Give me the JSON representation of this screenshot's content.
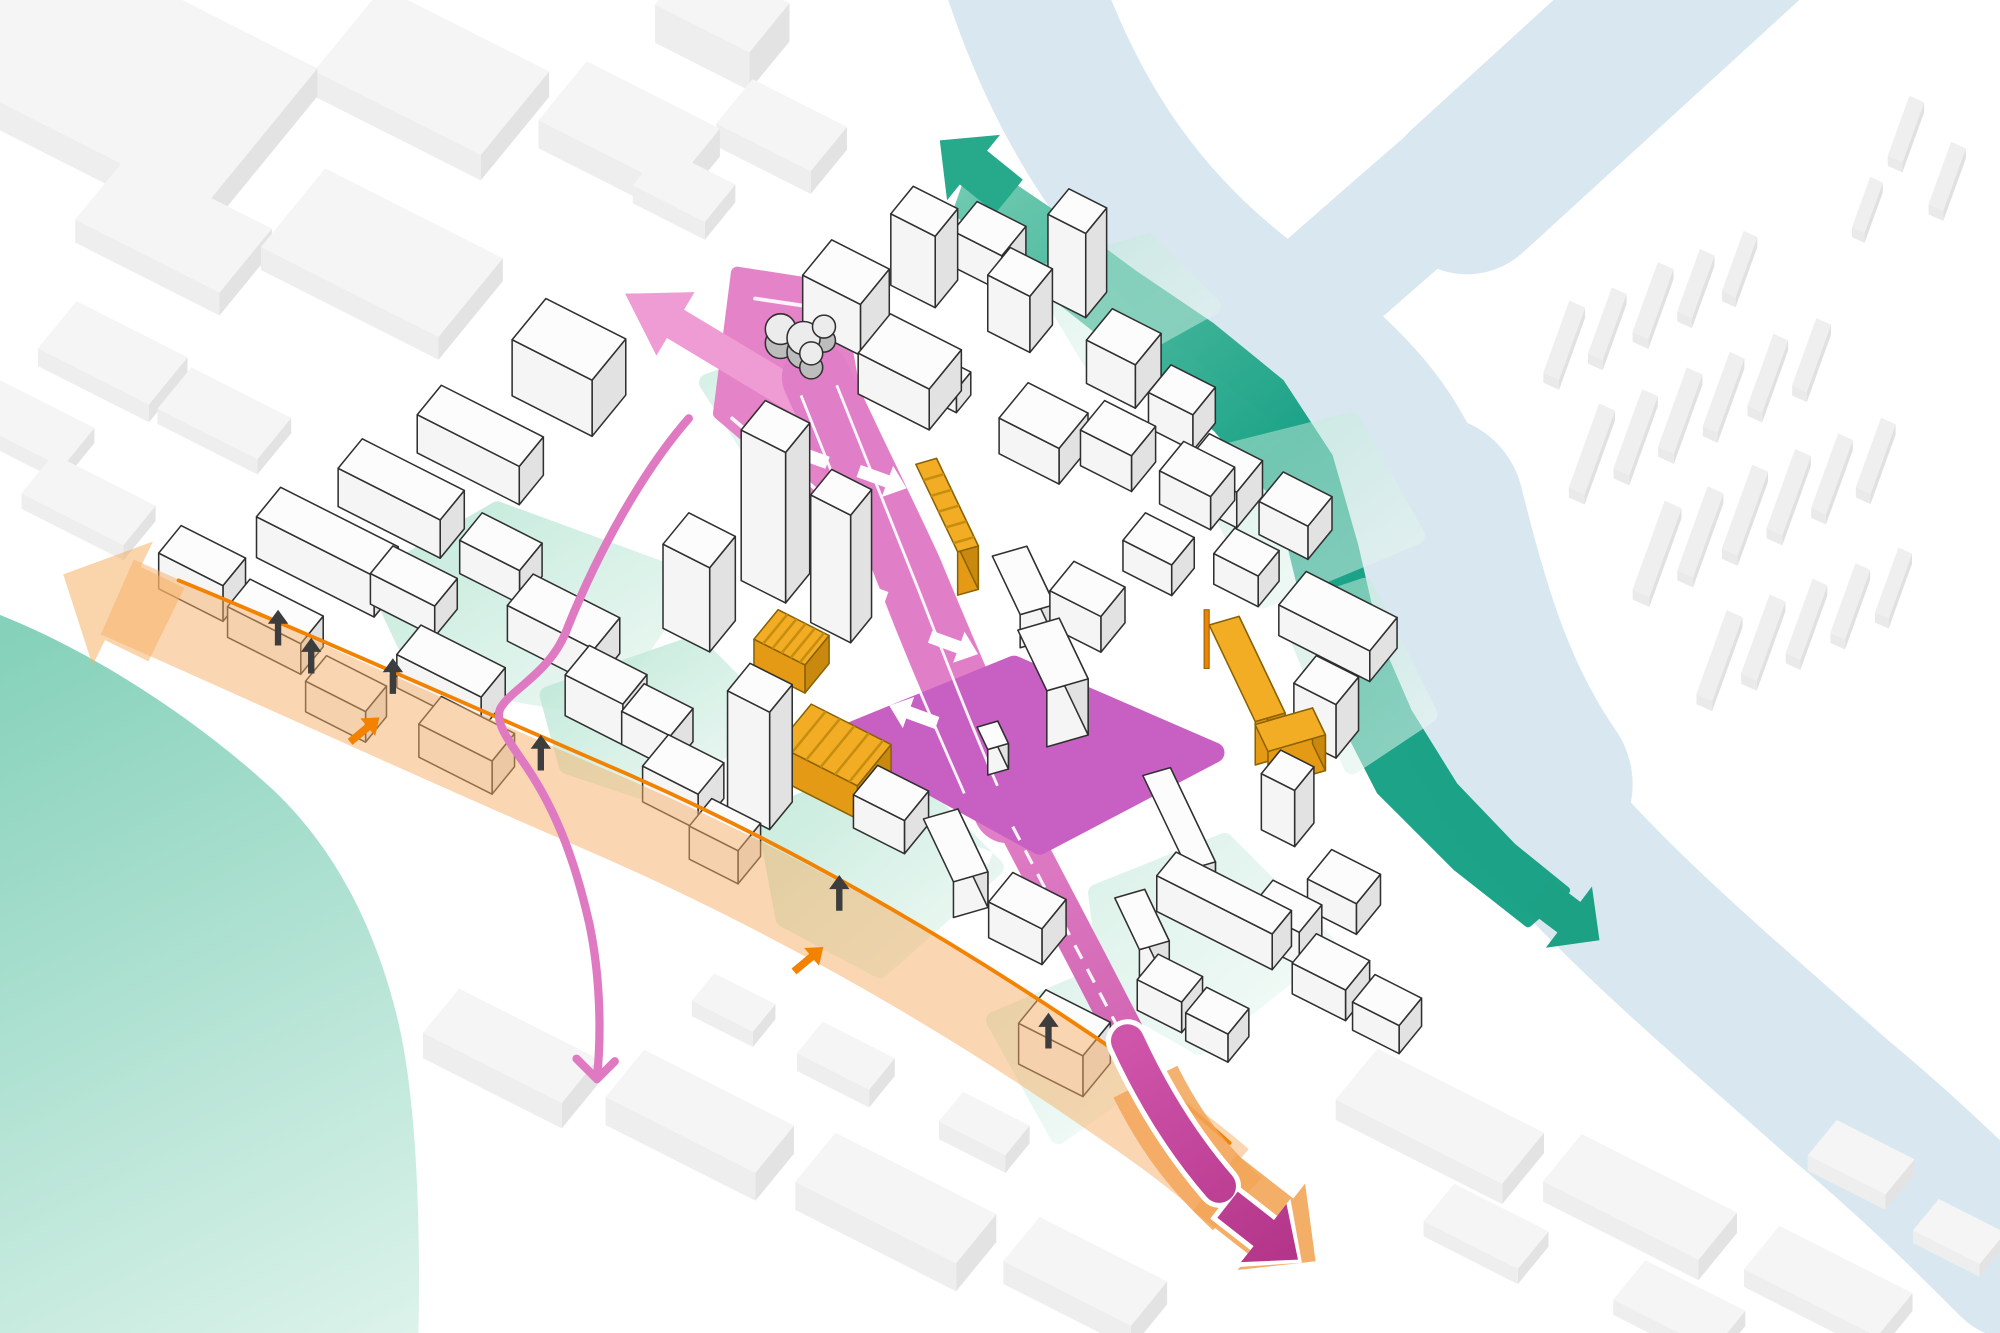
{
  "diagram_type": "urban-masterplan-axonometric",
  "palette": {
    "river": "#d9e8f0",
    "water_sw_dark": "#85d1ba",
    "water_sw_light": "#ddf3eb",
    "green_dark": "#14a083",
    "green_light": "#6cc9ae",
    "green_arrow_top": "#27a98b",
    "green_arrow_bottom": "#1da184",
    "mint": "#b7e6d4",
    "mint_fade": "#eef9f4",
    "street_pink": "#e07fc7",
    "street_pink_dark": "#cf5fae",
    "wedge_pink": "#e583c8",
    "arrow_pink_light": "#f09cd4",
    "branch_pink": "#df7ac2",
    "plaza_magenta": "#c85fc3",
    "exit_magenta_a": "#cf55aa",
    "exit_magenta_b": "#b23388",
    "orange_band": "#f6b066",
    "orange_line": "#f28200",
    "exit_orange": "#f2a558",
    "yellow_top": "#f3ad25",
    "yellow_light": "#e49a15",
    "yellow_dark": "#c9880e",
    "yellow_stroke": "#8a6200",
    "yellow_hatch": "#c78d0f",
    "district_top": "#fcfcfc",
    "district_light": "#f5f5f5",
    "district_dark": "#e2e2e2",
    "district_stroke": "#2f2f2f",
    "ctx_top": "#f5f5f5",
    "ctx_light": "#eeeeee",
    "ctx_dark": "#e3e3e3",
    "far_top": "#efefef",
    "far_light": "#eaeaea",
    "far_dark": "#e1e1e1",
    "black_arrow": "#3d3d3d",
    "white": "#ffffff",
    "blob_top": "#ececec",
    "blob_side": "#bdbdbd"
  },
  "river": {
    "paths": [
      {
        "d": "M800,-20 C840,100 900,180 980,240 C1060,300 1100,340 1120,420 C1140,500 1150,560 1200,630 C1260,705 1350,780 1440,860 C1500,910 1540,950 1580,990",
        "w": 120
      },
      {
        "d": "M1120,400 C1140,480 1160,550 1205,615",
        "w": 150
      },
      {
        "d": "M1010,250 C1090,180 1180,100 1280,20 L1340,-30",
        "w": 95
      },
      {
        "d": "M1150,150 L1380,-60",
        "w": 130
      }
    ]
  },
  "water_sw": {
    "d": "M0,482 C70,510 150,560 215,620 C265,668 295,730 312,800 C326,860 330,950 328,1050 L0,1050 Z"
  },
  "green_band": {
    "d": "M764,126 L826,168 L888,214 L950,256 L1004,300 L1042,358 L1062,428 L1078,498 L1104,558 L1140,616 L1186,664 L1228,698 L1198,724 L1142,680 L1082,620 L1044,546 L1022,468 L1004,394 L954,336 L890,282 L824,230 L750,166 Z",
    "heads": [
      {
        "cx": 764,
        "cy": 132,
        "ang": -141,
        "len": 70,
        "w": 34,
        "hw": 66,
        "hl": 34,
        "color_key": "green_arrow_top"
      },
      {
        "cx": 1230,
        "cy": 719,
        "ang": 37,
        "len": 60,
        "w": 30,
        "hw": 60,
        "hl": 30,
        "color_key": "green_arrow_bottom"
      }
    ]
  },
  "mint_areas": [
    {
      "d": "M295,455 L390,400 L540,455 L470,555 L330,530 Z",
      "o": 0.85
    },
    {
      "d": "M430,545 L545,505 L600,560 L520,625 L445,600 Z",
      "o": 0.85
    },
    {
      "d": "M555,300 L640,270 L680,330 L600,370 Z",
      "o": 0.6
    },
    {
      "d": "M815,215 L900,190 L950,240 L860,290 Z",
      "o": 0.45
    },
    {
      "d": "M940,360 L1060,330 L1110,420 L990,470 Z",
      "o": 0.5
    },
    {
      "d": "M1010,480 L1070,460 L1120,560 L1060,600 Z",
      "o": 0.55
    },
    {
      "d": "M600,640 L700,600 L780,680 L690,760 L615,720 Z",
      "o": 0.8
    },
    {
      "d": "M860,700 L960,660 L1040,740 L940,820 L870,780 Z",
      "o": 0.5
    },
    {
      "d": "M780,800 L850,770 L900,840 L830,890 Z",
      "o": 0.5
    }
  ],
  "pink_route": {
    "wedge": {
      "d": "M578,214 L655,226 L670,310 L702,396 L658,404 L564,324 Z"
    },
    "wedge_white_lines": [
      "M592,234 L646,242 L660,314 L686,388",
      "M652,394 L574,328"
    ],
    "top_arrow": {
      "cx": 578,
      "cy": 283,
      "ang": 211,
      "len": 205,
      "w": 26,
      "hw": 58,
      "hl": 46
    },
    "street_seg1": {
      "d": "M640,296 C660,340 690,400 712,448 C740,516 760,560 780,610 L790,634",
      "w": 54
    },
    "street_seg2": {
      "d": "M786,626 C810,672 830,710 852,752 C874,794 890,826 912,868",
      "w": 30
    },
    "connector": "820,612 776,632 756,592 800,572",
    "plaza": {
      "d": "M660,577 L795,522 L952,590 L815,662 Z"
    },
    "lane_lines": [
      "M628,310 C648,360 672,420 692,470 C716,532 736,576 756,622",
      "M656,302 C676,352 700,412 720,462 C744,524 762,570 782,616"
    ],
    "dashed_line": "M794,648 L906,862",
    "white_arrows": [
      {
        "x": 630,
        "y": 356,
        "ang": 200
      },
      {
        "x": 692,
        "y": 376,
        "ang": 20
      },
      {
        "x": 676,
        "y": 462,
        "ang": 200
      },
      {
        "x": 748,
        "y": 506,
        "ang": 20
      },
      {
        "x": 716,
        "y": 560,
        "ang": 200
      },
      {
        "x": 758,
        "y": 666,
        "ang": 200
      }
    ],
    "branch": {
      "d": "M540,328 C505,368 470,430 445,492 C432,528 400,540 392,556 C388,566 398,580 412,600 C438,638 452,680 462,724 C470,762 472,806 468,846",
      "w": 6.5,
      "head": [
        "M468,846 L452,830",
        "M468,846 L482,832"
      ]
    }
  },
  "orange_band": {
    "band": {
      "d": "M92,468 C210,520 340,580 470,636 C600,692 740,768 880,866 C912,888 935,905 958,925",
      "w": 64,
      "o": 0.5
    },
    "head": {
      "cx": 90,
      "cy": 470,
      "ang": 206,
      "len": 90,
      "w": 64,
      "hw": 108,
      "hl": 52,
      "o": 0.55
    },
    "boundary": "M140,455 C245,498 365,552 490,606 C618,662 754,740 892,836 C920,858 942,876 964,896",
    "small_arrows": [
      {
        "x": 286,
        "y": 572,
        "ang": -40
      },
      {
        "x": 634,
        "y": 752,
        "ang": -40
      }
    ]
  },
  "exit_arrows": {
    "orange_path": {
      "d": "M898,848 C920,892 942,918 970,944",
      "w": 56
    },
    "orange_head": {
      "cx": 992,
      "cy": 958,
      "ang": 38,
      "len": 100,
      "w": 56,
      "hw": 86,
      "hl": 44
    },
    "white_path": {
      "d": "M884,816 C906,864 930,900 956,930",
      "w": 34
    },
    "white_head": {
      "cx": 990,
      "cy": 966,
      "ang": 38,
      "len": 78,
      "w": 34,
      "hw": 68,
      "hl": 38
    },
    "magenta_path": {
      "d": "M884,816 C906,864 930,900 956,930",
      "w": 26
    },
    "magenta_head": {
      "cx": 990,
      "cy": 966,
      "ang": 38,
      "len": 70,
      "w": 26,
      "hw": 58,
      "hl": 34
    }
  },
  "black_arrows": [
    {
      "x": 218,
      "y": 492
    },
    {
      "x": 244,
      "y": 514
    },
    {
      "x": 308,
      "y": 530
    },
    {
      "x": 424,
      "y": 590
    },
    {
      "x": 658,
      "y": 700
    },
    {
      "x": 822,
      "y": 808
    }
  ],
  "buildings": {
    "context": [
      [
        40,
        -30,
        240,
        140,
        22
      ],
      [
        300,
        10,
        150,
        85,
        20
      ],
      [
        460,
        70,
        120,
        60,
        22
      ],
      [
        545,
        -5,
        85,
        50,
        30
      ],
      [
        590,
        80,
        85,
        45,
        18
      ],
      [
        100,
        140,
        130,
        65,
        18
      ],
      [
        255,
        150,
        160,
        80,
        18
      ],
      [
        60,
        250,
        100,
        48,
        14
      ],
      [
        0,
        310,
        85,
        40,
        12
      ],
      [
        42,
        368,
        92,
        40,
        12
      ],
      [
        150,
        300,
        90,
        42,
        12
      ],
      [
        520,
        130,
        65,
        38,
        14
      ],
      [
        360,
        795,
        125,
        45,
        20
      ],
      [
        505,
        845,
        135,
        48,
        22
      ],
      [
        655,
        910,
        145,
        50,
        22
      ],
      [
        815,
        972,
        115,
        45,
        18
      ],
      [
        560,
        775,
        55,
        28,
        12
      ],
      [
        645,
        815,
        65,
        32,
        14
      ],
      [
        755,
        870,
        60,
        30,
        14
      ],
      [
        1080,
        838,
        150,
        52,
        16
      ],
      [
        1240,
        905,
        140,
        48,
        16
      ],
      [
        1395,
        975,
        120,
        44,
        14
      ],
      [
        1140,
        940,
        85,
        38,
        12
      ],
      [
        1290,
        1000,
        90,
        40,
        12
      ],
      [
        1440,
        890,
        70,
        36,
        12
      ],
      [
        1520,
        950,
        60,
        32,
        10
      ]
    ],
    "far_slabs": [
      [
        1210,
        300,
        60,
        15
      ],
      [
        1245,
        285,
        55,
        14
      ],
      [
        1280,
        268,
        58,
        15
      ],
      [
        1315,
        252,
        52,
        14
      ],
      [
        1350,
        236,
        50,
        13
      ],
      [
        1230,
        390,
        70,
        15
      ],
      [
        1265,
        375,
        66,
        15
      ],
      [
        1300,
        358,
        66,
        15
      ],
      [
        1335,
        342,
        62,
        14
      ],
      [
        1370,
        326,
        60,
        14
      ],
      [
        1405,
        310,
        56,
        14
      ],
      [
        1280,
        470,
        74,
        16
      ],
      [
        1315,
        455,
        70,
        15
      ],
      [
        1350,
        438,
        70,
        15
      ],
      [
        1385,
        422,
        66,
        15
      ],
      [
        1420,
        406,
        62,
        14
      ],
      [
        1455,
        390,
        58,
        14
      ],
      [
        1330,
        552,
        70,
        15
      ],
      [
        1365,
        536,
        66,
        15
      ],
      [
        1400,
        520,
        62,
        14
      ],
      [
        1435,
        504,
        58,
        14
      ],
      [
        1470,
        488,
        54,
        13
      ],
      [
        1480,
        130,
        50,
        14
      ],
      [
        1512,
        168,
        52,
        14
      ],
      [
        1452,
        186,
        42,
        12
      ]
    ],
    "district": [
      [
        652,
        228,
        52,
        36,
        40,
        "A",
        "d"
      ],
      [
        716,
        202,
        40,
        28,
        56,
        "A",
        "d"
      ],
      [
        766,
        186,
        44,
        30,
        28,
        "A",
        "d"
      ],
      [
        698,
        278,
        64,
        40,
        32,
        "A",
        "d"
      ],
      [
        742,
        300,
        22,
        18,
        18,
        "A",
        "d"
      ],
      [
        792,
        238,
        38,
        28,
        44,
        "A",
        "d"
      ],
      [
        838,
        214,
        34,
        26,
        66,
        "A",
        "d"
      ],
      [
        872,
        276,
        44,
        32,
        34,
        "A",
        "d"
      ],
      [
        806,
        328,
        54,
        36,
        28,
        "A",
        "d"
      ],
      [
        866,
        342,
        46,
        30,
        28,
        "A",
        "d"
      ],
      [
        918,
        314,
        40,
        28,
        28,
        "A",
        "d"
      ],
      [
        928,
        372,
        46,
        30,
        26,
        "A",
        "d"
      ],
      [
        428,
        278,
        72,
        42,
        44,
        "A",
        "d"
      ],
      [
        346,
        332,
        92,
        30,
        30,
        "A",
        "d"
      ],
      [
        284,
        374,
        92,
        30,
        30,
        "A",
        "d"
      ],
      [
        220,
        414,
        106,
        30,
        32,
        "A",
        "d"
      ],
      [
        142,
        440,
        58,
        28,
        28,
        "A",
        "d"
      ],
      [
        196,
        478,
        66,
        28,
        24,
        "A",
        "d"
      ],
      [
        308,
        452,
        58,
        28,
        24,
        "A",
        "d"
      ],
      [
        378,
        428,
        54,
        28,
        26,
        "A",
        "d"
      ],
      [
        418,
        478,
        78,
        32,
        28,
        "A",
        "d"
      ],
      [
        330,
        516,
        76,
        30,
        26,
        "A",
        "d"
      ],
      [
        256,
        538,
        54,
        26,
        24,
        "A",
        "d"
      ],
      [
        346,
        572,
        66,
        28,
        26,
        "A",
        "d"
      ],
      [
        462,
        538,
        52,
        30,
        32,
        "A",
        "d"
      ],
      [
        600,
        432,
        40,
        30,
        118,
        "A",
        "d"
      ],
      [
        652,
        468,
        36,
        26,
        100,
        "A",
        "d"
      ],
      [
        540,
        468,
        42,
        32,
        66,
        "A",
        "d"
      ],
      [
        505,
        562,
        44,
        28,
        26,
        "A",
        "d"
      ],
      [
        588,
        612,
        38,
        28,
        92,
        "A",
        "d"
      ],
      [
        524,
        604,
        50,
        32,
        28,
        "A",
        "d"
      ],
      [
        558,
        652,
        44,
        28,
        26,
        "A",
        "d"
      ],
      [
        778,
        462,
        52,
        30,
        26,
        "B",
        "d"
      ],
      [
        842,
        468,
        46,
        30,
        28,
        "A",
        "d"
      ],
      [
        898,
        426,
        44,
        28,
        24,
        "A",
        "d"
      ],
      [
        798,
        538,
        54,
        36,
        44,
        "B",
        "d"
      ],
      [
        766,
        590,
        20,
        18,
        20,
        "B",
        "d"
      ],
      [
        948,
        368,
        48,
        32,
        28,
        "A",
        "d"
      ],
      [
        1006,
        396,
        44,
        30,
        26,
        "A",
        "d"
      ],
      [
        968,
        438,
        40,
        26,
        24,
        "A",
        "d"
      ],
      [
        1024,
        472,
        82,
        34,
        24,
        "A",
        "d"
      ],
      [
        1032,
        556,
        38,
        28,
        42,
        "A",
        "d"
      ],
      [
        896,
        636,
        84,
        24,
        28,
        "B",
        "d"
      ],
      [
        922,
        696,
        104,
        24,
        28,
        "A",
        "d"
      ],
      [
        1004,
        632,
        30,
        24,
        44,
        "A",
        "d"
      ],
      [
        1044,
        690,
        44,
        30,
        24,
        "A",
        "d"
      ],
      [
        688,
        626,
        46,
        30,
        26,
        "A",
        "d"
      ],
      [
        724,
        670,
        56,
        30,
        28,
        "B",
        "d"
      ],
      [
        794,
        712,
        48,
        30,
        28,
        "A",
        "d"
      ],
      [
        820,
        808,
        58,
        34,
        32,
        "A",
        "d"
      ],
      [
        874,
        742,
        46,
        26,
        38,
        "B",
        "d"
      ],
      [
        908,
        772,
        40,
        26,
        24,
        "A",
        "d"
      ],
      [
        946,
        796,
        38,
        26,
        22,
        "A",
        "d"
      ],
      [
        998,
        716,
        44,
        28,
        26,
        "A",
        "d"
      ],
      [
        1032,
        756,
        48,
        30,
        24,
        "A",
        "d"
      ],
      [
        1078,
        786,
        42,
        28,
        22,
        "A",
        "d"
      ],
      [
        718,
        398,
        78,
        18,
        34,
        "B",
        "y",
        1
      ],
      [
        610,
        500,
        46,
        30,
        22,
        "A",
        "y",
        1
      ],
      [
        636,
        578,
        72,
        42,
        26,
        "A",
        "y",
        1
      ],
      [
        948,
        524,
        86,
        26,
        34,
        "B",
        "y",
        0
      ],
      [
        984,
        596,
        24,
        50,
        28,
        "B",
        "y",
        0
      ]
    ],
    "blob_circles": [
      [
        612,
        258,
        12
      ],
      [
        630,
        265,
        13
      ],
      [
        646,
        256,
        9
      ],
      [
        636,
        277,
        9
      ]
    ],
    "pole": [
      944,
      478,
      4,
      46
    ]
  }
}
